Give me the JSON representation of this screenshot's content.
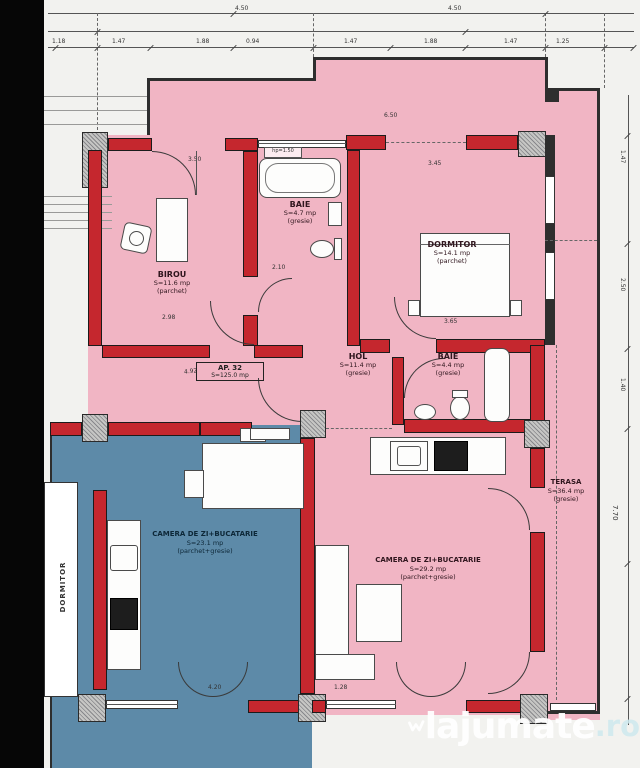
{
  "title_block": {
    "ap_label": "AP. 32",
    "ap_area": "S=125.0 mp"
  },
  "rooms": {
    "birou": {
      "name": "BIROU",
      "area": "S=11.6 mp",
      "finish": "(parchet)"
    },
    "baie1": {
      "name": "BAIE",
      "area": "S=4.7 mp",
      "finish": "(gresie)"
    },
    "dormitor": {
      "name": "DORMITOR",
      "area": "S=14.1 mp",
      "finish": "(parchet)"
    },
    "hol": {
      "name": "HOL",
      "area": "S=11.4 mp",
      "finish": "(gresie)"
    },
    "baie2": {
      "name": "BAIE",
      "area": "S=4.4 mp",
      "finish": "(gresie)"
    },
    "living": {
      "name": "CAMERA DE ZI+BUCATARIE",
      "area": "S=29.2 mp",
      "finish": "(parchet+gresie)"
    },
    "living_vecin": {
      "name": "CAMERA DE ZI+BUCATARIE",
      "area": "S=23.1 mp",
      "finish": "(parchet+gresie)"
    },
    "terasa": {
      "name": "TERASA",
      "area": "S=36.4 mp",
      "finish": "(gresie)"
    },
    "vecin": {
      "name": "DORMITOR"
    }
  },
  "annotations": {
    "hp": "hp=1.50"
  },
  "dims": {
    "d0": "4.50",
    "d1": "4.50",
    "d2": "1.18",
    "d3": "1.47",
    "d4": "1.88",
    "d5": "0.94",
    "d6": "1.47",
    "d7": "1.88",
    "d8": "1.47",
    "d9": "1.25",
    "d10": "6.50",
    "d11": "3.50",
    "d12": "2.98",
    "d13": "2.10",
    "d14": "3.45",
    "d15": "3.65",
    "d16": "4.92",
    "d17": "4.20",
    "d18": "1.28",
    "d19": "1.47",
    "d20": "2.50",
    "d21": "1.40",
    "d22": "7.70"
  },
  "watermark": {
    "brand": "lajumate",
    "tld": ".ro"
  },
  "colors": {
    "paper": "#f2f2ef",
    "pink": "#f1b5c4",
    "blue": "#5d8aa8",
    "wall_red": "#c5272e",
    "ink": "#2e2e2e"
  }
}
